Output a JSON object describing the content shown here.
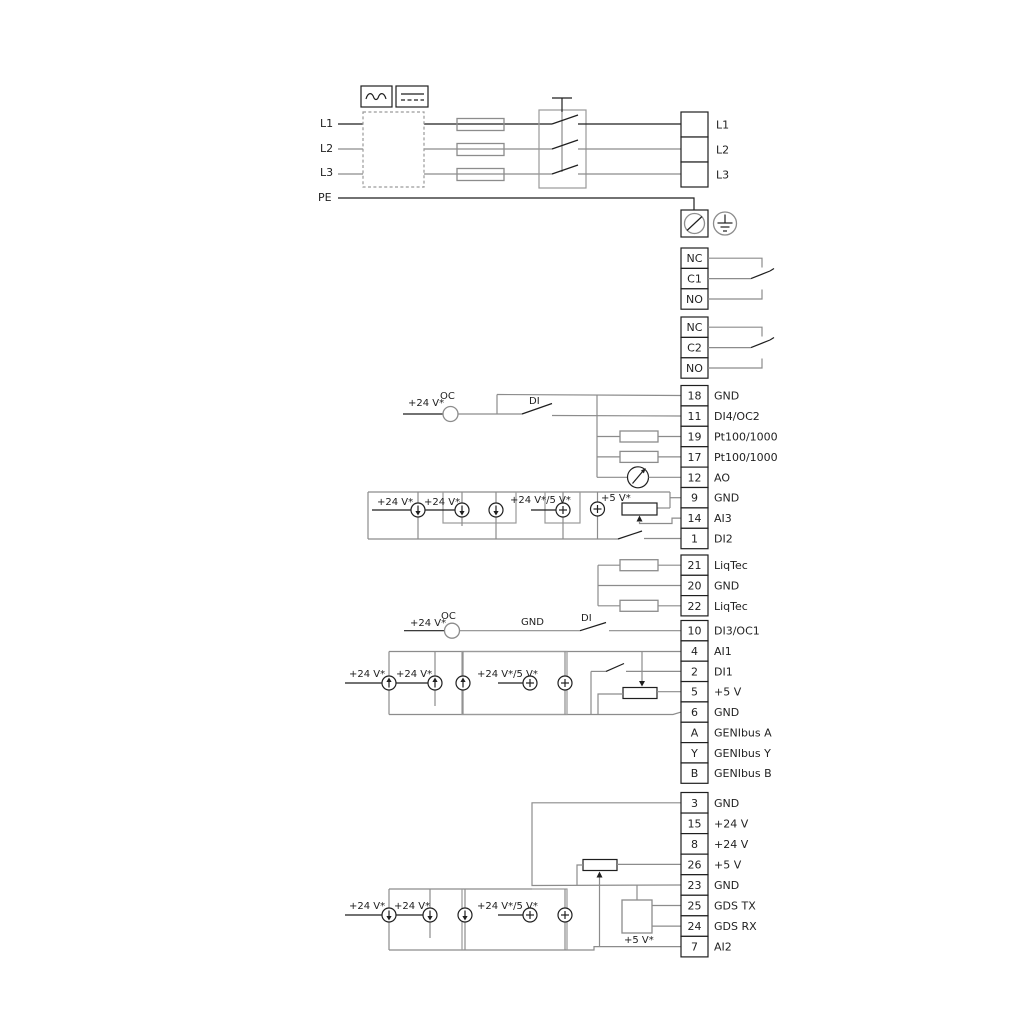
{
  "colors": {
    "wire_grey": "#8c8c8c",
    "wire_black": "#1f1f1f",
    "background": "#ffffff"
  },
  "mains": {
    "in": [
      "L1",
      "L2",
      "L3",
      "PE"
    ],
    "out": [
      "L1",
      "L2",
      "L3"
    ]
  },
  "relay1": [
    "NC",
    "C1",
    "NO"
  ],
  "relay2": [
    "NC",
    "C2",
    "NO"
  ],
  "io1": [
    {
      "n": "18",
      "l": "GND"
    },
    {
      "n": "11",
      "l": "DI4/OC2"
    },
    {
      "n": "19",
      "l": "Pt100/1000"
    },
    {
      "n": "17",
      "l": "Pt100/1000"
    },
    {
      "n": "12",
      "l": "AO"
    },
    {
      "n": "9",
      "l": "GND"
    },
    {
      "n": "14",
      "l": "AI3"
    },
    {
      "n": "1",
      "l": "DI2"
    }
  ],
  "liqtec": [
    {
      "n": "21",
      "l": "LiqTec"
    },
    {
      "n": "20",
      "l": "GND"
    },
    {
      "n": "22",
      "l": "LiqTec"
    }
  ],
  "io2": [
    {
      "n": "10",
      "l": "DI3/OC1"
    },
    {
      "n": "4",
      "l": "AI1"
    },
    {
      "n": "2",
      "l": "DI1"
    },
    {
      "n": "5",
      "l": "+5 V"
    },
    {
      "n": "6",
      "l": "GND"
    },
    {
      "n": "A",
      "l": "GENIbus A"
    },
    {
      "n": "Y",
      "l": "GENIbus Y"
    },
    {
      "n": "B",
      "l": "GENIbus B"
    }
  ],
  "io3": [
    {
      "n": "3",
      "l": "GND"
    },
    {
      "n": "15",
      "l": "+24 V"
    },
    {
      "n": "8",
      "l": "+24 V"
    },
    {
      "n": "26",
      "l": "+5 V"
    },
    {
      "n": "23",
      "l": "GND"
    },
    {
      "n": "25",
      "l": "GDS TX"
    },
    {
      "n": "24",
      "l": "GDS RX"
    },
    {
      "n": "7",
      "l": "AI2"
    }
  ],
  "ann": {
    "oc2_v": "+24 V*",
    "oc2_oc": "OC",
    "oc2_di": "DI",
    "ai3_v1": "+24 V*",
    "ai3_v2": "+24 V*",
    "ai3_v45": "+24 V*/5 V*",
    "ai3_v5": "+5 V*",
    "oc1_v": "+24 V*",
    "oc1_oc": "OC",
    "oc1_gnd": "GND",
    "oc1_di": "DI",
    "ai1_v1": "+24 V*",
    "ai1_v2": "+24 V*",
    "ai1_v45": "+24 V*/5 V*",
    "ai2_v1": "+24 V*",
    "ai2_v2": "+24 V*",
    "ai2_v45": "+24 V*/5 V*",
    "ai2_v5": "+5 V*"
  }
}
